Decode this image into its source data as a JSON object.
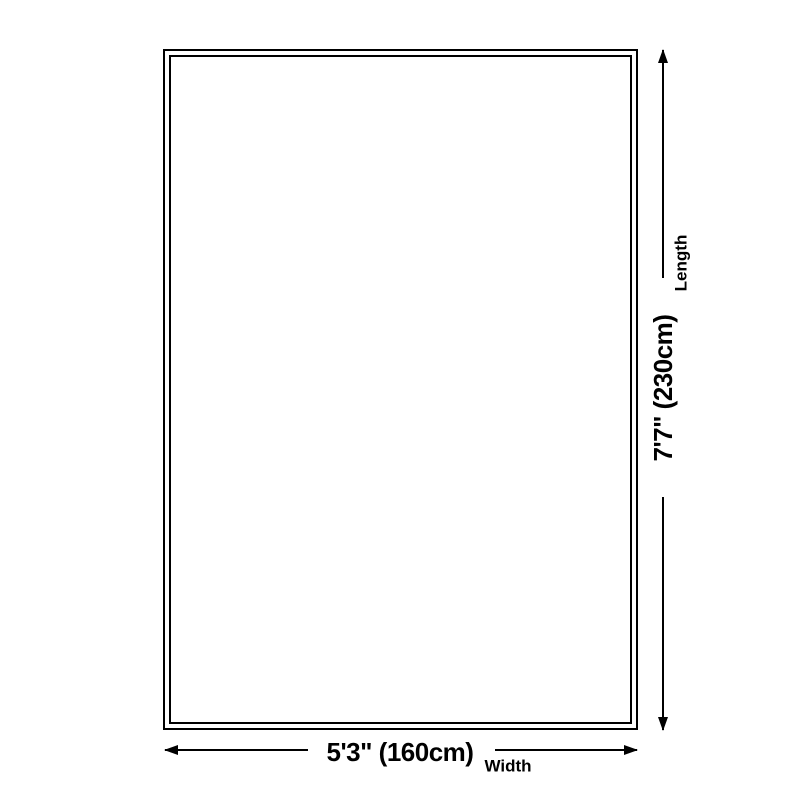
{
  "diagram": {
    "length": {
      "label": "Length",
      "value": "7'7\" (230cm)"
    },
    "width": {
      "label": "Width",
      "value": "5'3\" (160cm)"
    }
  },
  "colors": {
    "background": "#ffffff",
    "line": "#000000",
    "text": "#000000"
  }
}
